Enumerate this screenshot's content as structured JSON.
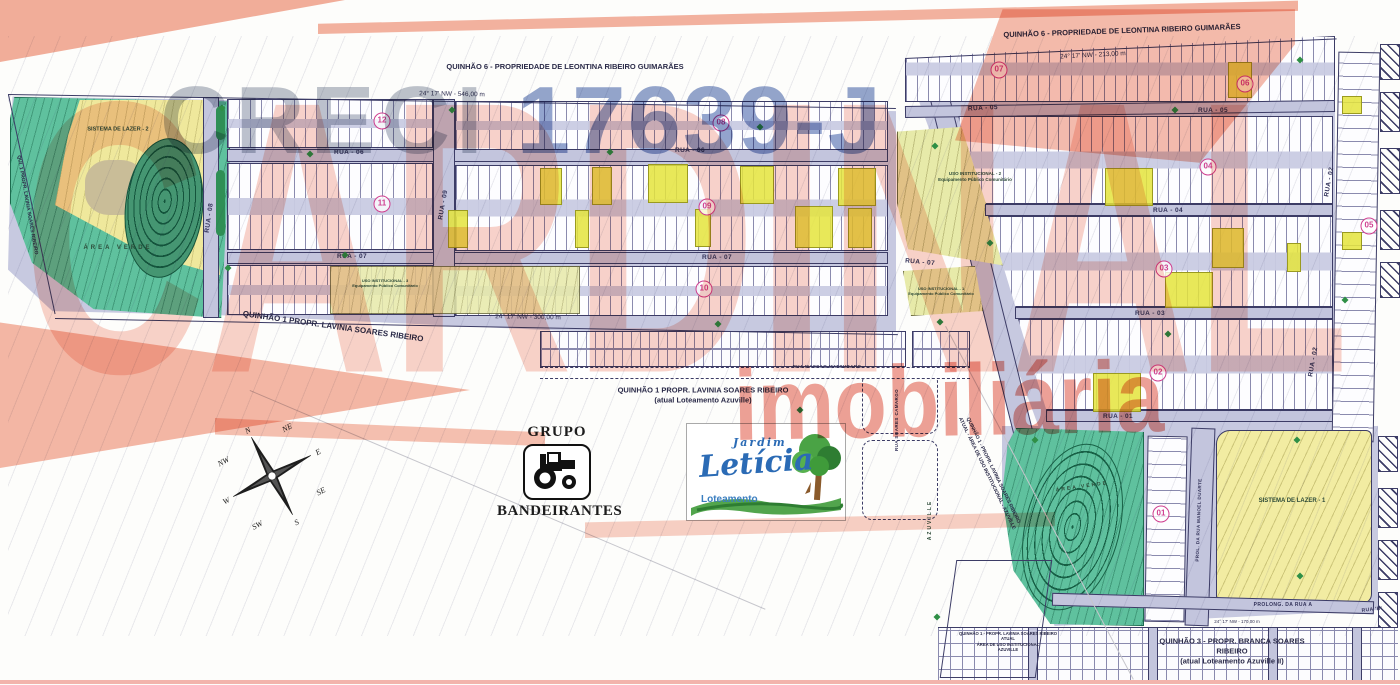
{
  "watermarks": {
    "creci": "CRECI",
    "creci_number": "17639-J",
    "cardinal": "CARDINAL",
    "imobiliaria": "imobiliária",
    "salmon_color": "#f2a691",
    "red_color": "#e25443",
    "blue_color": "#5873ad"
  },
  "map": {
    "ownership": [
      {
        "lines": [
          "QUINHÃO 6 - PROPRIEDADE DE LEONTINA RIBEIRO GUIMARÃES"
        ],
        "x": 565,
        "y": 67,
        "fs": 7.5
      },
      {
        "lines": [
          "QUINHÃO 6 - PROPRIEDADE DE LEONTINA RIBEIRO GUIMARÃES"
        ],
        "x": 1122,
        "y": 31,
        "fs": 7.5,
        "rot": -2
      },
      {
        "lines": [
          "QUINHÃO 1 PROPR. LAVINIA SOARES RIBEIRO"
        ],
        "x": 333,
        "y": 327,
        "fs": 8,
        "rot": 8
      },
      {
        "lines": [
          "QUINHÃO 1 PROPR. LAVINIA SOARES RIBEIRO",
          "(atual Loteamento Azuville)"
        ],
        "x": 703,
        "y": 395,
        "fs": 7.5
      },
      {
        "lines": [
          "QUINHÃO 1 - PROPR. LAVINIA SOARES RIBEIRO",
          "ATUAL",
          "ÁREA DE USO INSTITUCIONAL",
          "AZUVILLE"
        ],
        "x": 1008,
        "y": 642,
        "fs": 4.2
      },
      {
        "lines": [
          "QUINHÃO 3 - PROPR. BRANCA SOARES RIBEIRO",
          "(atual Loteamento Azuville  II)"
        ],
        "x": 1232,
        "y": 651,
        "fs": 7.5
      },
      {
        "lines": [
          "QUINHÃO 1 - PROPR. LAVINIA SOARES RIBEIRO",
          "ATUAL - ÁREA DE USO INSTITUCIONAL - AZUVILLE"
        ],
        "x": 990,
        "y": 472,
        "fs": 5,
        "rot": 64
      },
      {
        "lines": [
          "QUI. 1 PROPR. LAVINIA SOARES RIBEIRO"
        ],
        "x": 27,
        "y": 205,
        "fs": 5,
        "rot": 80
      }
    ],
    "streets": [
      {
        "t": "RUA - 06",
        "x": 349,
        "y": 153
      },
      {
        "t": "RUA - 06",
        "x": 690,
        "y": 151
      },
      {
        "t": "RUA - 07",
        "x": 352,
        "y": 257
      },
      {
        "t": "RUA - 07",
        "x": 717,
        "y": 258
      },
      {
        "t": "RUA - 07",
        "x": 920,
        "y": 263,
        "rot": 5
      },
      {
        "t": "RUA - 08",
        "x": 210,
        "y": 218,
        "rot": -82
      },
      {
        "t": "RUA - 09",
        "x": 444,
        "y": 205,
        "rot": -80
      },
      {
        "t": "RUA - 05",
        "x": 983,
        "y": 109,
        "rot": -3
      },
      {
        "t": "RUA - 05",
        "x": 1213,
        "y": 111
      },
      {
        "t": "RUA - 04",
        "x": 1168,
        "y": 211
      },
      {
        "t": "RUA - 03",
        "x": 1150,
        "y": 314
      },
      {
        "t": "RUA - 01",
        "x": 1118,
        "y": 417
      },
      {
        "t": "RUA - 02",
        "x": 1330,
        "y": 182,
        "rot": -80
      },
      {
        "t": "RUA - 02",
        "x": 1314,
        "y": 362,
        "rot": -80
      },
      {
        "t": "RUA SOARES CAMARGO",
        "x": 897,
        "y": 420,
        "rot": -90,
        "fs": 4.5
      },
      {
        "t": "RUA MASSAO MATSUBARO",
        "x": 827,
        "y": 367,
        "fs": 4.5
      },
      {
        "t": "PROL. DA RUA MANOEL DUARTE",
        "x": 1199,
        "y": 520,
        "rot": -88,
        "fs": 4.5
      },
      {
        "t": "PROLONG. DA RUA A",
        "x": 1283,
        "y": 605,
        "fs": 5
      },
      {
        "t": "RUA 'B'",
        "x": 1372,
        "y": 610,
        "fs": 5,
        "rot": -6
      }
    ],
    "dimensions": [
      {
        "t": "24° 17' NW - 546,00 m",
        "x": 452,
        "y": 95,
        "rot": 1
      },
      {
        "t": "24° 17' NW - 213,00 m",
        "x": 1093,
        "y": 56,
        "rot": -3
      },
      {
        "t": "24° 17' NW - 300,00 m",
        "x": 528,
        "y": 318,
        "rot": 1
      },
      {
        "t": "24° 17' NW - 170,00 m",
        "x": 1237,
        "y": 622,
        "fs": 4.5
      }
    ],
    "areas": [
      {
        "lines": [
          "SISTEMA DE LAZER - 2"
        ],
        "x": 118,
        "y": 130,
        "fs": 5.5
      },
      {
        "lines": [
          "ÁREA VERDE"
        ],
        "x": 118,
        "y": 249,
        "fs": 6,
        "ls": 3
      },
      {
        "lines": [
          "USO INSTITUCIONAL - 2",
          "Equipamento Público Comunitário"
        ],
        "x": 975,
        "y": 177,
        "fs": 4.5
      },
      {
        "lines": [
          "USO INSTITUCIONAL - 3",
          "Equipamento Público Comunitário"
        ],
        "x": 385,
        "y": 283,
        "fs": 4
      },
      {
        "lines": [
          "USO INSTITUCIONAL - 1",
          "Equipamento Público Comunitário"
        ],
        "x": 941,
        "y": 291,
        "fs": 4
      },
      {
        "lines": [
          "SISTEMA DE LAZER - 1"
        ],
        "x": 1292,
        "y": 502,
        "fs": 6
      },
      {
        "lines": [
          "ÁREA VERDE"
        ],
        "x": 1082,
        "y": 487,
        "fs": 5,
        "ls": 2,
        "rot": -8
      },
      {
        "lines": [
          "AZUVILLE"
        ],
        "x": 930,
        "y": 520,
        "fs": 5,
        "rot": -90,
        "ls": 2
      }
    ],
    "quadras": [
      {
        "n": "12",
        "x": 382,
        "y": 121
      },
      {
        "n": "11",
        "x": 382,
        "y": 204
      },
      {
        "n": "08",
        "x": 721,
        "y": 123
      },
      {
        "n": "09",
        "x": 707,
        "y": 207
      },
      {
        "n": "10",
        "x": 704,
        "y": 289
      },
      {
        "n": "07",
        "x": 999,
        "y": 70
      },
      {
        "n": "06",
        "x": 1245,
        "y": 84
      },
      {
        "n": "04",
        "x": 1208,
        "y": 167
      },
      {
        "n": "05",
        "x": 1369,
        "y": 226
      },
      {
        "n": "03",
        "x": 1164,
        "y": 269
      },
      {
        "n": "02",
        "x": 1158,
        "y": 373
      },
      {
        "n": "01",
        "x": 1161,
        "y": 514
      }
    ],
    "trees": [
      [
        222,
        108
      ],
      [
        310,
        154
      ],
      [
        452,
        110
      ],
      [
        610,
        152
      ],
      [
        760,
        127
      ],
      [
        935,
        146
      ],
      [
        1175,
        110
      ],
      [
        1300,
        60
      ],
      [
        228,
        268
      ],
      [
        718,
        324
      ],
      [
        940,
        322
      ],
      [
        1168,
        334
      ],
      [
        800,
        410
      ],
      [
        1035,
        440
      ],
      [
        1297,
        440
      ],
      [
        1300,
        576
      ],
      [
        937,
        617
      ],
      [
        345,
        255
      ],
      [
        1345,
        300
      ],
      [
        990,
        243
      ]
    ]
  },
  "logos": {
    "grupo": {
      "top": "GRUPO",
      "bottom": "BANDEIRANTES"
    },
    "leticia": {
      "jardim": "Jardim",
      "name": "Letícia",
      "sub": "Loteamento"
    }
  },
  "compass": {
    "points": [
      "N",
      "NE",
      "E",
      "SE",
      "S",
      "SW",
      "W",
      "NW"
    ]
  }
}
